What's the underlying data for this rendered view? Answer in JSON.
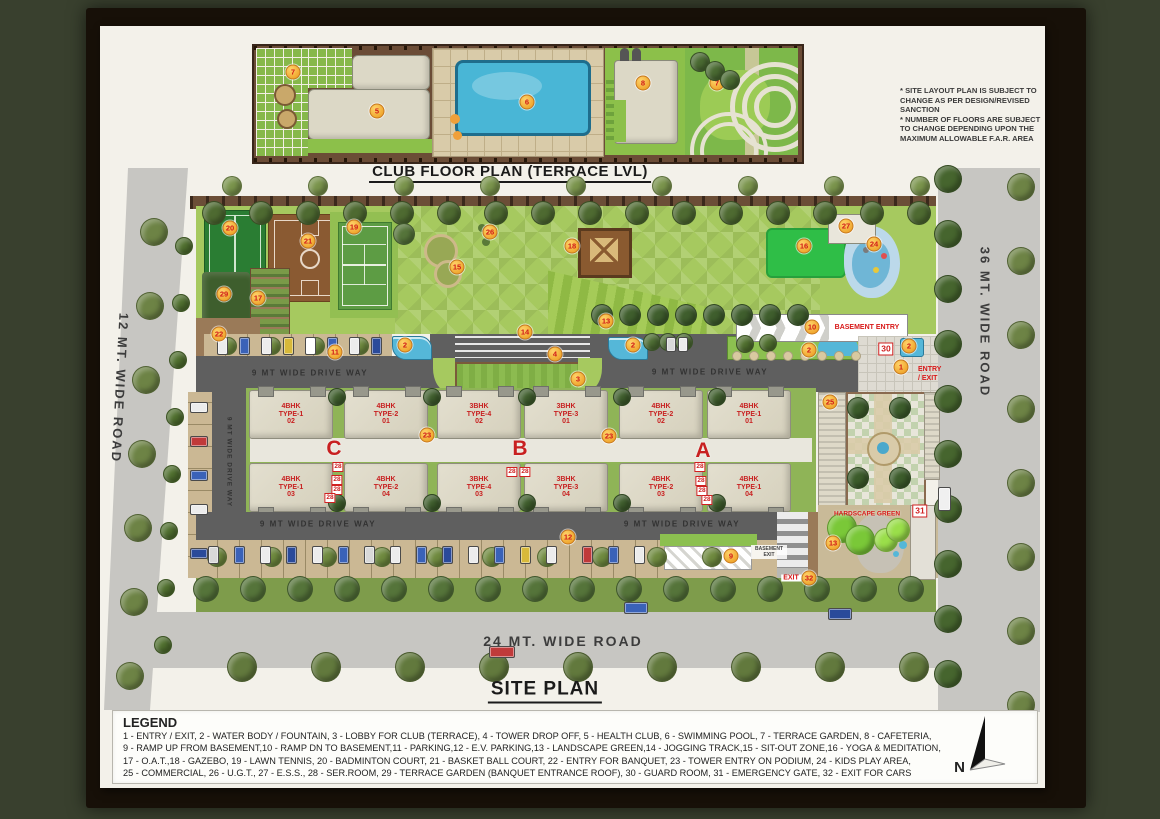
{
  "sheet": {
    "club_plan_title": "CLUB FLOOR PLAN (TERRACE LVL)",
    "site_plan_title": "SITE PLAN",
    "disclaimer_lines": [
      "* SITE LAYOUT PLAN IS SUBJECT TO",
      "CHANGE AS PER DESIGN/REVISED",
      "SANCTION",
      "* NUMBER OF FLOORS ARE SUBJECT",
      "TO CHANGE DEPENDING UPON THE",
      "MAXIMUM ALLOWABLE F.A.R. AREA"
    ]
  },
  "roads": {
    "left_label": "12 MT. WIDE ROAD",
    "right_label": "36 MT. WIDE ROAD",
    "bottom_label": "24 MT. WIDE ROAD",
    "driveway_label": "9 MT WIDE DRIVE WAY"
  },
  "labels": {
    "basement_entry": "BASEMENT ENTRY",
    "basement_exit_line1": "BASEMENT",
    "basement_exit_line2": "EXIT",
    "entry_exit_line1": "ENTRY",
    "entry_exit_line2": "/ EXIT",
    "exit_cars": "EXIT",
    "hardscape_green": "HARDSCAPE GREEN"
  },
  "towers": [
    {
      "letter": "C",
      "x": 334,
      "y": 449
    },
    {
      "letter": "B",
      "x": 520,
      "y": 449
    },
    {
      "letter": "A",
      "x": 703,
      "y": 451
    }
  ],
  "buildings": [
    {
      "lines": [
        "4BHK",
        "TYPE-1",
        "02"
      ],
      "cx": 290,
      "row": "top"
    },
    {
      "lines": [
        "4BHK",
        "TYPE-2",
        "01"
      ],
      "cx": 385,
      "row": "top"
    },
    {
      "lines": [
        "3BHK",
        "TYPE-4",
        "02"
      ],
      "cx": 478,
      "row": "top"
    },
    {
      "lines": [
        "3BHK",
        "TYPE-3",
        "01"
      ],
      "cx": 565,
      "row": "top"
    },
    {
      "lines": [
        "4BHK",
        "TYPE-2",
        "02"
      ],
      "cx": 660,
      "row": "top"
    },
    {
      "lines": [
        "4BHK",
        "TYPE-1",
        "01"
      ],
      "cx": 748,
      "row": "top"
    },
    {
      "lines": [
        "4BHK",
        "TYPE-1",
        "03"
      ],
      "cx": 290,
      "row": "bottom"
    },
    {
      "lines": [
        "4BHK",
        "TYPE-2",
        "04"
      ],
      "cx": 385,
      "row": "bottom"
    },
    {
      "lines": [
        "3BHK",
        "TYPE-4",
        "03"
      ],
      "cx": 478,
      "row": "bottom"
    },
    {
      "lines": [
        "3BHK",
        "TYPE-3",
        "04"
      ],
      "cx": 565,
      "row": "bottom"
    },
    {
      "lines": [
        "4BHK",
        "TYPE-2",
        "03"
      ],
      "cx": 660,
      "row": "bottom"
    },
    {
      "lines": [
        "4BHK",
        "TYPE-1",
        "04"
      ],
      "cx": 748,
      "row": "bottom"
    }
  ],
  "markers": {
    "club": [
      {
        "n": "7",
        "x": 293,
        "y": 72
      },
      {
        "n": "5",
        "x": 377,
        "y": 111
      },
      {
        "n": "6",
        "x": 527,
        "y": 102
      },
      {
        "n": "8",
        "x": 643,
        "y": 83
      },
      {
        "n": "7",
        "x": 717,
        "y": 83
      }
    ],
    "site": [
      {
        "n": "20",
        "x": 230,
        "y": 228
      },
      {
        "n": "21",
        "x": 308,
        "y": 241
      },
      {
        "n": "19",
        "x": 354,
        "y": 227
      },
      {
        "n": "26",
        "x": 490,
        "y": 232
      },
      {
        "n": "15",
        "x": 457,
        "y": 267
      },
      {
        "n": "29",
        "x": 224,
        "y": 294
      },
      {
        "n": "17",
        "x": 258,
        "y": 298
      },
      {
        "n": "22",
        "x": 219,
        "y": 334
      },
      {
        "n": "18",
        "x": 572,
        "y": 246
      },
      {
        "n": "13",
        "x": 606,
        "y": 321
      },
      {
        "n": "16",
        "x": 804,
        "y": 246
      },
      {
        "n": "24",
        "x": 874,
        "y": 244
      },
      {
        "n": "27",
        "x": 846,
        "y": 226
      },
      {
        "n": "14",
        "x": 525,
        "y": 332
      },
      {
        "n": "4",
        "x": 555,
        "y": 354
      },
      {
        "n": "11",
        "x": 335,
        "y": 352
      },
      {
        "n": "2",
        "x": 405,
        "y": 345
      },
      {
        "n": "2",
        "x": 633,
        "y": 345
      },
      {
        "n": "2",
        "x": 809,
        "y": 350
      },
      {
        "n": "2",
        "x": 909,
        "y": 346
      },
      {
        "n": "10",
        "x": 812,
        "y": 327
      },
      {
        "n": "3",
        "x": 578,
        "y": 379
      },
      {
        "n": "1",
        "x": 901,
        "y": 367
      },
      {
        "n": "23",
        "x": 427,
        "y": 435
      },
      {
        "n": "23",
        "x": 609,
        "y": 436
      },
      {
        "n": "25",
        "x": 830,
        "y": 402
      },
      {
        "n": "12",
        "x": 568,
        "y": 537
      },
      {
        "n": "9",
        "x": 731,
        "y": 556
      },
      {
        "n": "13",
        "x": 833,
        "y": 543
      },
      {
        "n": "32",
        "x": 809,
        "y": 578
      }
    ]
  },
  "service_boxes": [
    {
      "n": "28",
      "x": 338,
      "y": 467
    },
    {
      "n": "28",
      "x": 337,
      "y": 480
    },
    {
      "n": "28",
      "x": 337,
      "y": 490
    },
    {
      "n": "28",
      "x": 330,
      "y": 498
    },
    {
      "n": "28",
      "x": 512,
      "y": 472
    },
    {
      "n": "28",
      "x": 525,
      "y": 472
    },
    {
      "n": "28",
      "x": 700,
      "y": 467
    },
    {
      "n": "28",
      "x": 701,
      "y": 481
    },
    {
      "n": "28",
      "x": 702,
      "y": 491
    },
    {
      "n": "28",
      "x": 707,
      "y": 500
    },
    {
      "n": "30",
      "x": 886,
      "y": 349,
      "big": true
    },
    {
      "n": "31",
      "x": 920,
      "y": 511,
      "big": true
    }
  ],
  "legend": {
    "heading": "LEGEND",
    "lines": [
      "1 - ENTRY / EXIT, 2 - WATER BODY / FOUNTAIN, 3 - LOBBY FOR CLUB (TERRACE), 4 - TOWER DROP OFF, 5 - HEALTH CLUB, 6 - SWIMMING POOL, 7 - TERRACE GARDEN, 8 - CAFETERIA,",
      "9 - RAMP UP FROM BASEMENT,10 - RAMP DN TO BASEMENT,11 - PARKING,12 - E.V. PARKING,13 - LANDSCAPE GREEN,14 - JOGGING TRACK,15 - SIT-OUT ZONE,16 - YOGA & MEDITATION,",
      "17 - O.A.T.,18 - GAZEBO, 19 - LAWN TENNIS, 20 - BADMINTON COURT, 21 - BASKET BALL COURT, 22 - ENTRY FOR BANQUET, 23 - TOWER ENTRY ON PODIUM, 24 - KIDS PLAY AREA,",
      "25 - COMMERCIAL, 26 - U.G.T., 27 - E.S.S., 28 - SER.ROOM, 29 - TERRACE GARDEN (BANQUET ENTRANCE ROOF), 30 - GUARD ROOM, 31 - EMERGENCY GATE, 32 - EXIT FOR CARS"
    ]
  },
  "compass": {
    "label": "N"
  },
  "colors": {
    "accent_red": "#d81818",
    "marker_orange": "#f0a830",
    "road_gray": "#c7c6c2",
    "drive_gray": "#5f5f5f",
    "grass_green": "#a6c95f",
    "frame_dark": "#171008",
    "paper": "#f3f1ea"
  },
  "decor": {
    "tree_rows": [
      {
        "x0": 214,
        "y0": 213,
        "dx": 47,
        "dy": 0,
        "n": 16,
        "r": 11,
        "c": "#4e6a31"
      },
      {
        "x0": 232,
        "y0": 186,
        "dx": 86,
        "dy": 0,
        "n": 9,
        "r": 9,
        "c": "#7a944c"
      },
      {
        "x0": 154,
        "y0": 232,
        "dx": -4,
        "dy": 74,
        "n": 7,
        "r": 13,
        "c": "#6d8345"
      },
      {
        "x0": 184,
        "y0": 246,
        "dx": -3,
        "dy": 57,
        "n": 8,
        "r": 8,
        "c": "#50702f"
      },
      {
        "x0": 948,
        "y0": 179,
        "dx": 0,
        "dy": 55,
        "n": 10,
        "r": 13,
        "c": "#46652e"
      },
      {
        "x0": 1021,
        "y0": 187,
        "dx": 0,
        "dy": 74,
        "n": 8,
        "r": 13,
        "c": "#6d8345"
      },
      {
        "x0": 206,
        "y0": 589,
        "dx": 47,
        "dy": 0,
        "n": 16,
        "r": 12,
        "c": "#55743a"
      },
      {
        "x0": 242,
        "y0": 667,
        "dx": 84,
        "dy": 0,
        "n": 9,
        "r": 14,
        "c": "#62793d"
      },
      {
        "x0": 217,
        "y0": 557,
        "dx": 55,
        "dy": 0,
        "n": 10,
        "r": 9,
        "c": "#6f8a3f"
      },
      {
        "x0": 602,
        "y0": 315,
        "dx": 28,
        "dy": 0,
        "n": 8,
        "r": 10,
        "c": "#3f5e2d"
      },
      {
        "x0": 337,
        "y0": 397,
        "dx": 95,
        "dy": 0,
        "n": 5,
        "r": 8,
        "c": "#3f5e2d"
      },
      {
        "x0": 337,
        "y0": 503,
        "dx": 95,
        "dy": 0,
        "n": 5,
        "r": 8,
        "c": "#3f5e2d"
      },
      {
        "x0": 700,
        "y0": 62,
        "dx": 15,
        "dy": 9,
        "n": 3,
        "r": 9,
        "c": "#4a6a32"
      },
      {
        "x0": 858,
        "y0": 408,
        "dx": 42,
        "dy": 0,
        "n": 2,
        "r": 10,
        "c": "#3c5c2b"
      },
      {
        "x0": 858,
        "y0": 478,
        "dx": 42,
        "dy": 0,
        "n": 2,
        "r": 10,
        "c": "#3c5c2b"
      },
      {
        "x0": 652,
        "y0": 342,
        "dx": 16,
        "dy": 0,
        "n": 3,
        "r": 8,
        "c": "#4d6c33"
      },
      {
        "x0": 745,
        "y0": 344,
        "dx": 23,
        "dy": -1,
        "n": 2,
        "r": 8,
        "c": "#50702f"
      },
      {
        "x0": 228,
        "y0": 346,
        "dx": 44,
        "dy": 0,
        "n": 4,
        "r": 8,
        "c": "#6f8a3f"
      },
      {
        "x0": 404,
        "y0": 234,
        "dx": 0,
        "dy": 0,
        "n": 1,
        "r": 10,
        "c": "#55743a"
      },
      {
        "x0": 842,
        "y0": 528,
        "dx": 18,
        "dy": 12,
        "n": 2,
        "r": 14,
        "c": "#7ac838"
      },
      {
        "x0": 886,
        "y0": 540,
        "dx": 12,
        "dy": -10,
        "n": 2,
        "r": 11,
        "c": "#9ade4a"
      }
    ],
    "cars": [
      {
        "x": 217,
        "y": 337,
        "w": 9,
        "h": 16,
        "c": "#ececec"
      },
      {
        "x": 239,
        "y": 337,
        "w": 9,
        "h": 16,
        "c": "#3a62b8"
      },
      {
        "x": 261,
        "y": 337,
        "w": 9,
        "h": 16,
        "c": "#ececec"
      },
      {
        "x": 283,
        "y": 337,
        "w": 9,
        "h": 16,
        "c": "#d8b93a"
      },
      {
        "x": 305,
        "y": 337,
        "w": 9,
        "h": 16,
        "c": "#ffffff"
      },
      {
        "x": 327,
        "y": 337,
        "w": 9,
        "h": 16,
        "c": "#3a62b8"
      },
      {
        "x": 349,
        "y": 337,
        "w": 9,
        "h": 16,
        "c": "#ececec"
      },
      {
        "x": 371,
        "y": 337,
        "w": 9,
        "h": 16,
        "c": "#2a4a9a"
      },
      {
        "x": 190,
        "y": 402,
        "w": 16,
        "h": 9,
        "c": "#ececec"
      },
      {
        "x": 190,
        "y": 436,
        "w": 16,
        "h": 9,
        "c": "#c03a3a"
      },
      {
        "x": 190,
        "y": 470,
        "w": 16,
        "h": 9,
        "c": "#3a62b8"
      },
      {
        "x": 190,
        "y": 504,
        "w": 16,
        "h": 9,
        "c": "#ececec"
      },
      {
        "x": 190,
        "y": 548,
        "w": 16,
        "h": 9,
        "c": "#2a4a9a"
      },
      {
        "x": 208,
        "y": 546,
        "w": 9,
        "h": 16,
        "c": "#d9d9d9"
      },
      {
        "x": 234,
        "y": 546,
        "w": 9,
        "h": 16,
        "c": "#3a62b8"
      },
      {
        "x": 260,
        "y": 546,
        "w": 9,
        "h": 16,
        "c": "#ececec"
      },
      {
        "x": 286,
        "y": 546,
        "w": 9,
        "h": 16,
        "c": "#2a4a9a"
      },
      {
        "x": 312,
        "y": 546,
        "w": 9,
        "h": 16,
        "c": "#ececec"
      },
      {
        "x": 338,
        "y": 546,
        "w": 9,
        "h": 16,
        "c": "#3a62b8"
      },
      {
        "x": 364,
        "y": 546,
        "w": 9,
        "h": 16,
        "c": "#d9d9d9"
      },
      {
        "x": 390,
        "y": 546,
        "w": 9,
        "h": 16,
        "c": "#ececec"
      },
      {
        "x": 416,
        "y": 546,
        "w": 9,
        "h": 16,
        "c": "#3a62b8"
      },
      {
        "x": 442,
        "y": 546,
        "w": 9,
        "h": 16,
        "c": "#2a4a9a"
      },
      {
        "x": 468,
        "y": 546,
        "w": 9,
        "h": 16,
        "c": "#ececec"
      },
      {
        "x": 494,
        "y": 546,
        "w": 9,
        "h": 16,
        "c": "#3a62b8"
      },
      {
        "x": 520,
        "y": 546,
        "w": 9,
        "h": 16,
        "c": "#d8b93a"
      },
      {
        "x": 546,
        "y": 546,
        "w": 9,
        "h": 16,
        "c": "#ececec"
      },
      {
        "x": 582,
        "y": 546,
        "w": 9,
        "h": 16,
        "c": "#c03a3a"
      },
      {
        "x": 608,
        "y": 546,
        "w": 9,
        "h": 16,
        "c": "#3a62b8"
      },
      {
        "x": 634,
        "y": 546,
        "w": 9,
        "h": 16,
        "c": "#ececec"
      },
      {
        "x": 666,
        "y": 337,
        "w": 8,
        "h": 13,
        "c": "#d9d9d9"
      },
      {
        "x": 678,
        "y": 337,
        "w": 8,
        "h": 13,
        "c": "#ececec"
      },
      {
        "x": 938,
        "y": 487,
        "w": 11,
        "h": 22,
        "c": "#f0f0f0"
      },
      {
        "x": 489,
        "y": 646,
        "w": 24,
        "h": 10,
        "c": "#c03a3a"
      },
      {
        "x": 624,
        "y": 602,
        "w": 22,
        "h": 10,
        "c": "#3a62b8"
      },
      {
        "x": 828,
        "y": 608,
        "w": 22,
        "h": 10,
        "c": "#2a4a9a"
      }
    ],
    "stones": [
      {
        "x0": 737,
        "y0": 356,
        "dx": 17,
        "n": 8,
        "r": 4,
        "c": "#d8c9a0"
      }
    ]
  }
}
